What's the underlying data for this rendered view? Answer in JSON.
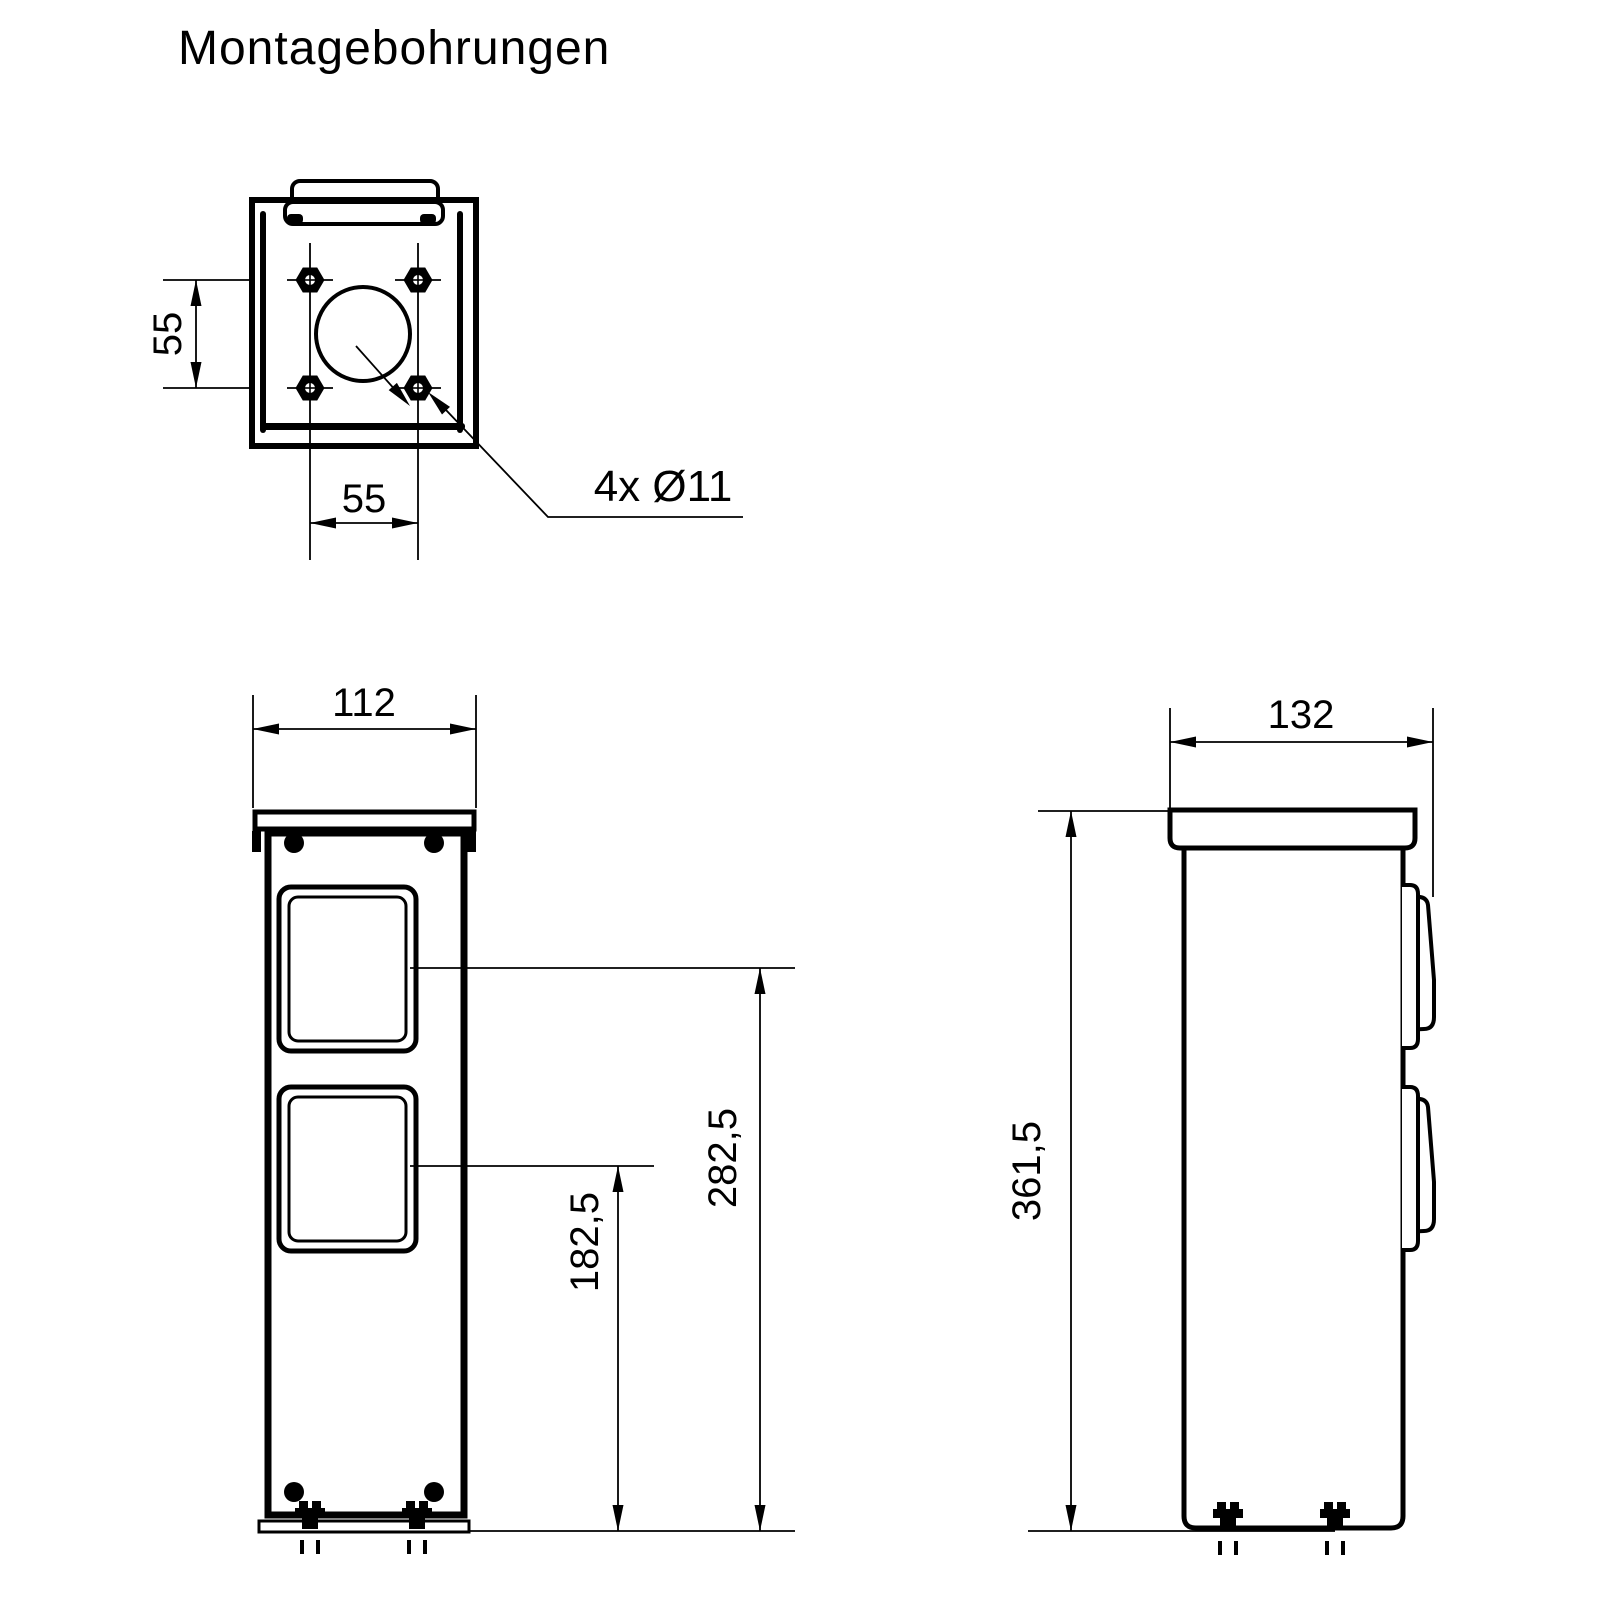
{
  "title": "Montagebohrungen",
  "colors": {
    "line": "#000000",
    "background": "#ffffff"
  },
  "top_view": {
    "dim_vertical": "55",
    "dim_horizontal": "55",
    "hole_callout": "4x Ø11"
  },
  "front_view": {
    "dim_width": "112",
    "dim_upper_socket": "282,5",
    "dim_lower_socket": "182,5"
  },
  "side_view": {
    "dim_depth": "132",
    "dim_height": "361,5"
  }
}
